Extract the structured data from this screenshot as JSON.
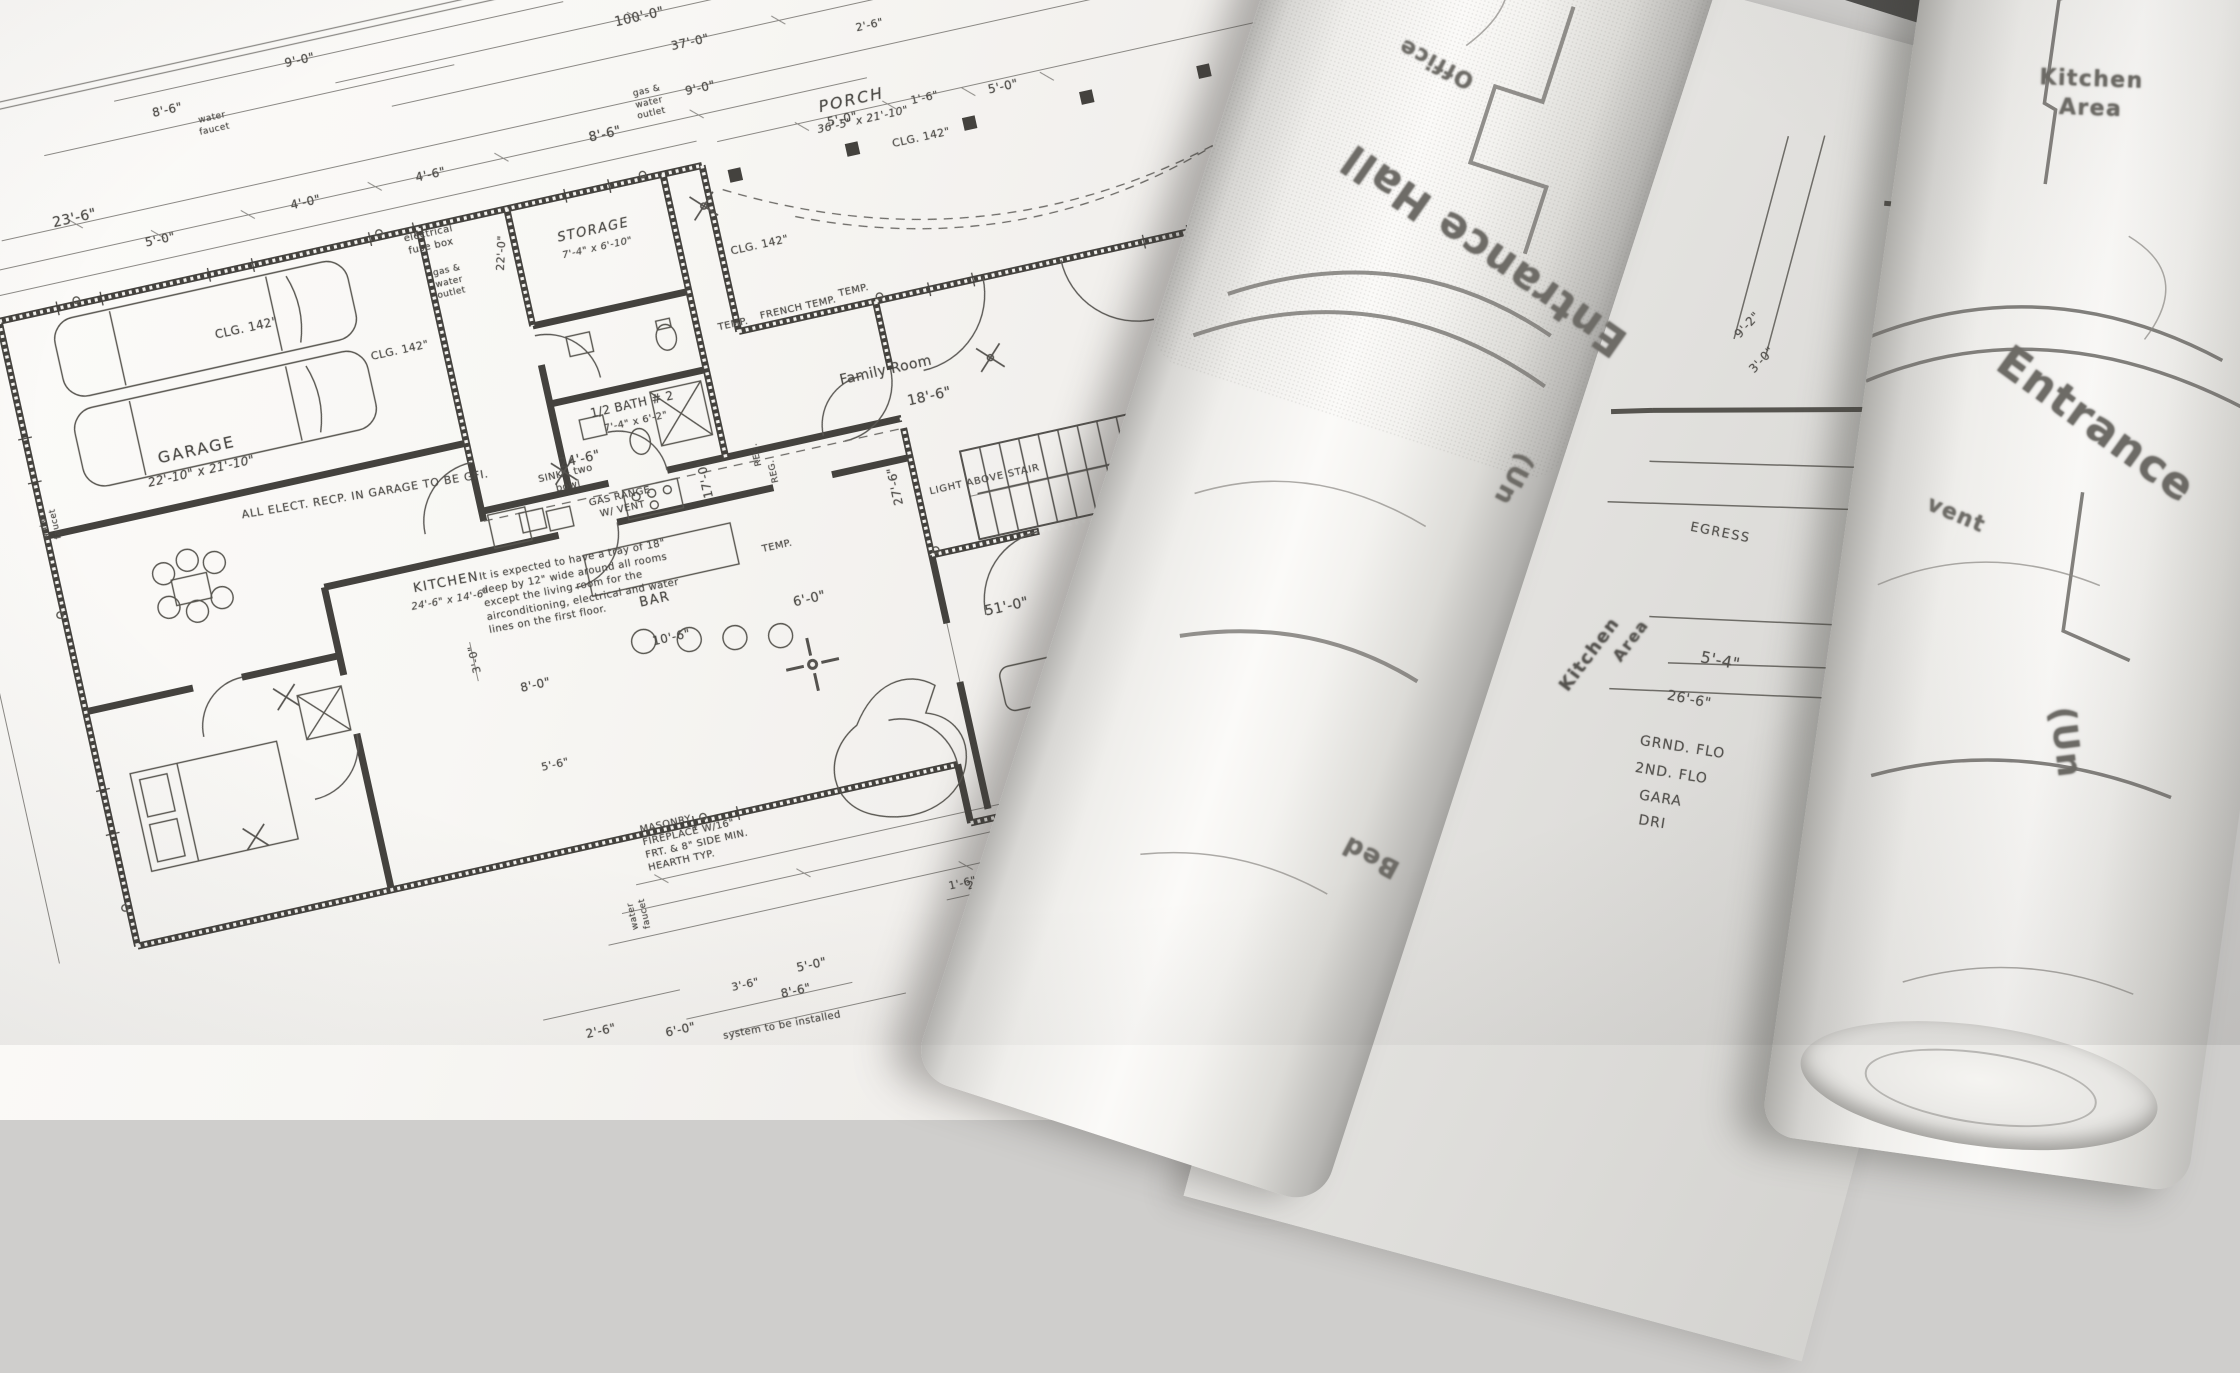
{
  "scene": {
    "type": "photograph",
    "subject": "Architectural blueprint floor plan with two rolled drawings on top"
  },
  "plan": {
    "rooms": {
      "garage": "GARAGE",
      "garage_size": "22'-10\" x 21'-10\"",
      "storage": "STORAGE",
      "storage_size": "7'-4\" x 6'-10\"",
      "half_bath": "1/2 BATH # 2",
      "half_bath_size": "7'-4\" x 6'-2\"",
      "porch": "PORCH",
      "porch_size": "36'-5\" x 21'-10\"",
      "family_room": "Family Room",
      "bar": "BAR",
      "portico": "PORTICO",
      "portico_size": "38'-11\" x 35'-4\"",
      "living_partial": "Livin"
    },
    "notes": {
      "kitchen_title": "KITCHEN",
      "kitchen_size": "24'-6\" x 14'-6\"",
      "kitchen_text": "It is expected to have a tray of 18\" deep by 12\" wide around all rooms except the living room for the airconditioning, electrical and water lines on the first floor.",
      "gfi": "ALL ELECT. RECP. IN GARAGE TO BE GFI.",
      "fireplace": "MASONRY\nFIREPLACE W/16\"\nFRT. & 8\" SIDE MIN.\nHEARTH TYP.",
      "light_above_stair": "LIGHT ABOVE STAIR",
      "electrical_fuse_box": "electrical\nfuse box",
      "gas_water_outlet": "gas &\nwater\noutlet",
      "water_faucet": "water\nfaucet",
      "sink": "SINK - two\nbowl",
      "gas_range": "GAS RANGE\nW/ VENT",
      "system_note": "system to be installed",
      "temp": "TEMP.",
      "french_temp": "FRENCH TEMP.",
      "lintel": "LINTEL",
      "reg": "REG.",
      "clg_142": "CLG. 142\"",
      "clg_240": "CLG. 240\"",
      "table_diameter": "18'"
    },
    "dims": {
      "d100_0": "100'-0\"",
      "d37_0": "37'-0\"",
      "d9_0": "9'-0\"",
      "d23_6": "23'-6\"",
      "d5_0": "5'-0\"",
      "d4_0": "4'-0\"",
      "d4_6": "4'-6\"",
      "d8_6": "8'-6\"",
      "d1_6": "1'-6\"",
      "d2_6": "2'-6\"",
      "d7_0": "7'-0\"",
      "d24_6": "24'-6\"",
      "d17_0": "17'-0\"",
      "d27_6": "27'-6\"",
      "d18_6": "18'-6\"",
      "d23_4": "23'-4\"",
      "d51_0": "51'-0\"",
      "d6_0": "6'-0\"",
      "d10_6": "10'-6\"",
      "d8_0": "8'-0\"",
      "d3_0": "3'-0\"",
      "d5_6": "5'-6\"",
      "d10_8": "10'-8\"",
      "d2_0": "2'-0\"",
      "d8in": "8\"",
      "d1_4": "1'-4\"",
      "d4in": "4\"",
      "d3_1": "3'-1\"",
      "d2_7": "2'-7\"",
      "d19_6": "19'-6\"",
      "d20_0": "20'-0\"",
      "d22_0": "22'-0\"",
      "d3_6": "3'-6\""
    }
  },
  "side_sheet": {
    "egress": "EGRESS",
    "d5_4": "5'-4\"",
    "d26_6": "26'-6\"",
    "grnd_flo": "GRND. FLO",
    "second_flo": "2ND. FLO",
    "gara": "GARA",
    "dri": "DRI",
    "d9_2": "9'-2\"",
    "d3_0": "3'-0\"",
    "kitchen": "Kitchen",
    "area": "Area"
  },
  "rolls": {
    "left": {
      "office": "Office",
      "entrance_hall": "Entrance Hall",
      "unfinished_partial": "(Un",
      "bed": "Bed"
    },
    "right": {
      "kitchen_area": "Kitchen\nArea",
      "entrance": "Entrance",
      "vent": "vent",
      "unfinished_partial": "(Un"
    }
  },
  "colors": {
    "paper": "#f6f5f2",
    "ink": "#4b4945",
    "background": "#cfcecc",
    "wall": "#44423e"
  }
}
